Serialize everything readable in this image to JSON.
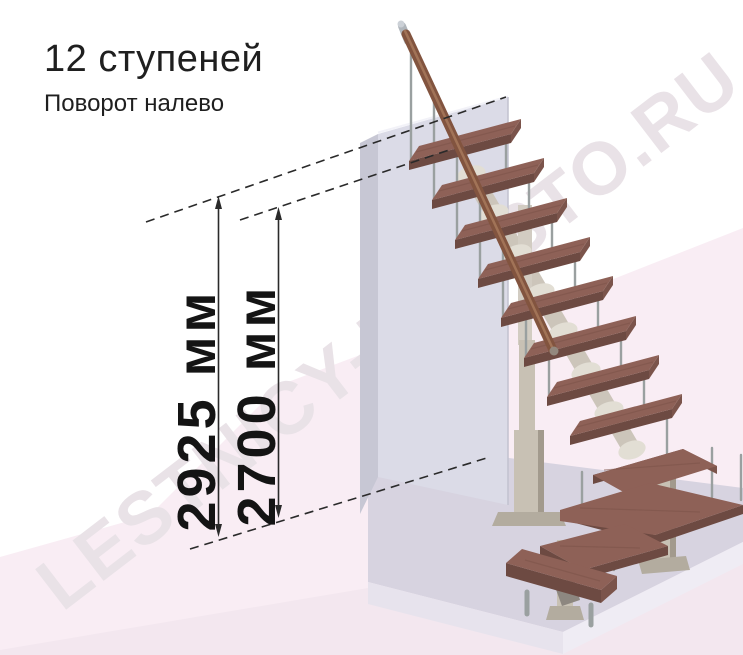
{
  "header": {
    "title": "12 ступеней",
    "subtitle": "Поворот налево"
  },
  "dimensions": {
    "overall_height": "2925 мм",
    "flight_height": "2700 мм"
  },
  "watermark": {
    "text": "LESTNICY-PROSTO.RU"
  },
  "colors": {
    "floor_pink": "#f9edf4",
    "floor_pink_band": "#f3e7ef",
    "platform_top": "#d7d3e0",
    "platform_front": "#e7e3ed",
    "platform_side": "#efecf4",
    "wall_front": "#dbdbe7",
    "wall_side": "#c7c7d4",
    "tread_top": "#8e6157",
    "tread_front": "#6d4a42",
    "tread_side": "#7b544b",
    "rail_wood": "#82543f",
    "metal": "#9aa0a0",
    "column": "#c8c1b4",
    "dimension_ink": "#2a2a2a",
    "watermark_color": "#e9e2e7"
  }
}
